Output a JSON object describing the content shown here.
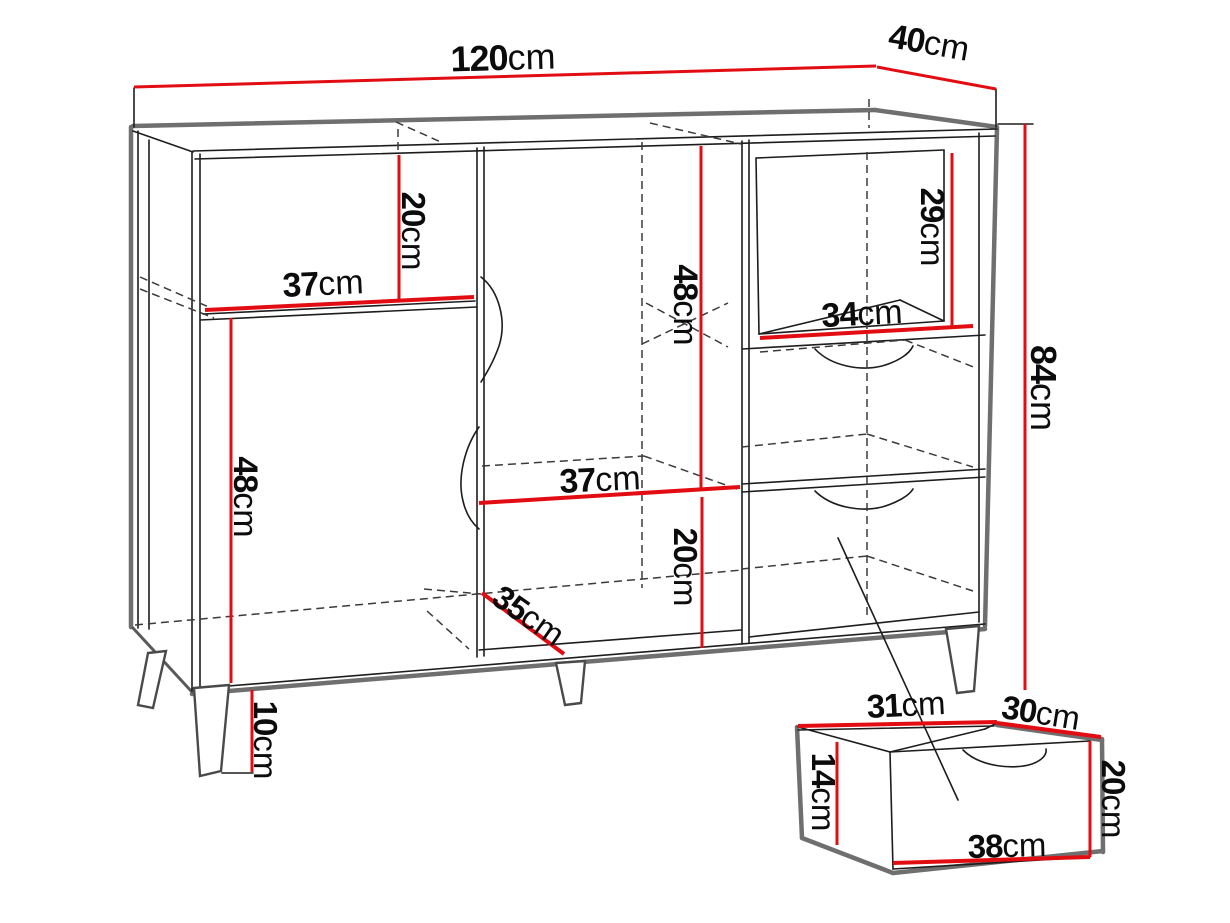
{
  "diagram": {
    "title": "Sideboard dimension drawing",
    "unit": "cm",
    "accent_color": "#e20d12",
    "outline_color": "#6f6f6f",
    "line_color": "#1d1d1d",
    "cabinet": {
      "overall_width": {
        "value": "120",
        "unit": "cm"
      },
      "overall_depth": {
        "value": "40",
        "unit": "cm"
      },
      "overall_height": {
        "value": "84",
        "unit": "cm"
      },
      "left_niche_height": {
        "value": "20",
        "unit": "cm"
      },
      "left_shelf_width": {
        "value": "37",
        "unit": "cm"
      },
      "left_door_height": {
        "value": "48",
        "unit": "cm"
      },
      "middle_open_height": {
        "value": "48",
        "unit": "cm"
      },
      "middle_shelf_width": {
        "value": "37",
        "unit": "cm"
      },
      "middle_lower_height": {
        "value": "20",
        "unit": "cm"
      },
      "bottom_shelf_depth": {
        "value": "35",
        "unit": "cm"
      },
      "right_niche_height": {
        "value": "29",
        "unit": "cm"
      },
      "right_niche_width": {
        "value": "34",
        "unit": "cm"
      },
      "leg_height": {
        "value": "10",
        "unit": "cm"
      }
    },
    "drawer_detail": {
      "top_width": {
        "value": "31",
        "unit": "cm"
      },
      "top_depth": {
        "value": "30",
        "unit": "cm"
      },
      "side_height": {
        "value": "14",
        "unit": "cm"
      },
      "front_height": {
        "value": "20",
        "unit": "cm"
      },
      "front_width": {
        "value": "38",
        "unit": "cm"
      }
    }
  }
}
